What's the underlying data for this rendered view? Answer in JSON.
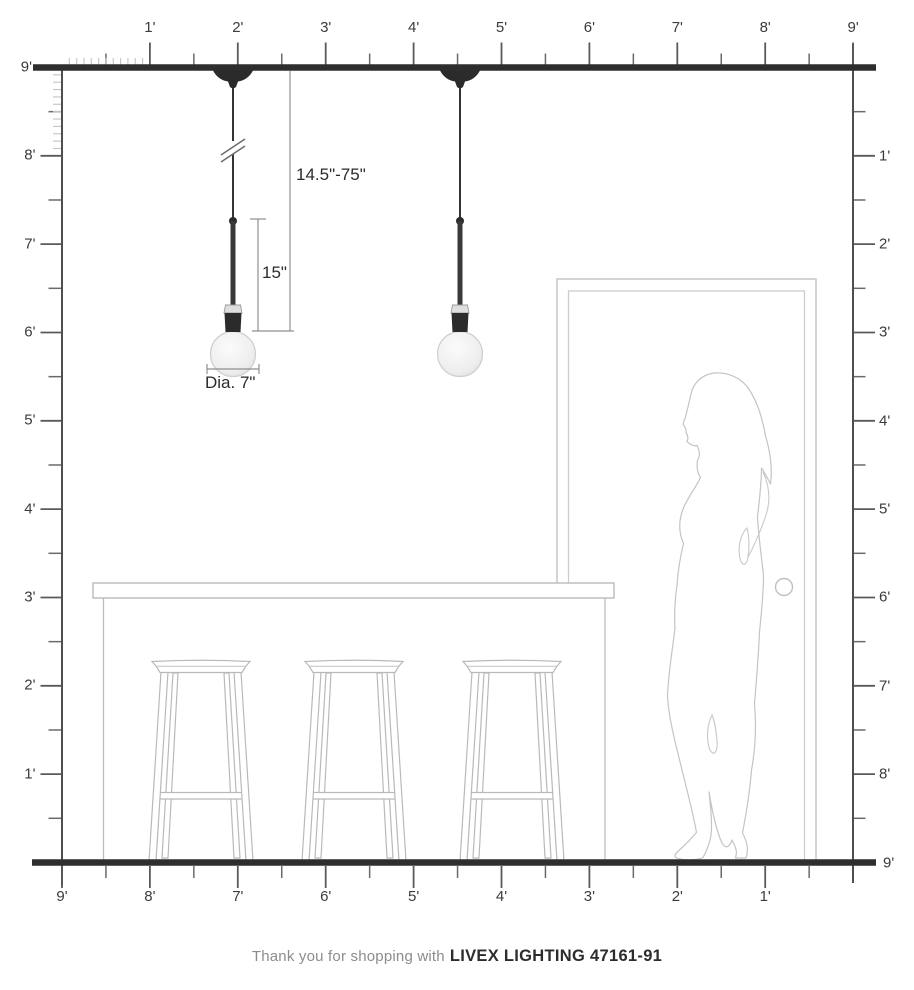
{
  "footer": {
    "prefix": "Thank you for shopping with",
    "brand": "LIVEX LIGHTING 47161-91"
  },
  "annotations": {
    "hang_range": "14.5\"-75\"",
    "fixture_height": "15\"",
    "fixture_diameter": "Dia. 7\""
  },
  "rulers": {
    "unit": "feet",
    "top": {
      "labels": [
        "1'",
        "2'",
        "3'",
        "4'",
        "5'",
        "6'",
        "7'",
        "8'",
        "9'"
      ]
    },
    "left": {
      "labels": [
        "9'",
        "8'",
        "7'",
        "6'",
        "5'",
        "4'",
        "3'",
        "2'",
        "1'"
      ]
    },
    "right": {
      "labels": [
        "1'",
        "2'",
        "3'",
        "4'",
        "5'",
        "6'",
        "7'",
        "8'",
        "9'"
      ]
    },
    "bottom": {
      "labels": [
        "9'",
        "8'",
        "7'",
        "6'",
        "5'",
        "4'",
        "3'",
        "2'",
        "1'"
      ]
    }
  },
  "scene": {
    "pendant_count": 2,
    "stool_count": 3
  },
  "colors": {
    "structure_line": "#2e2e2e",
    "ruler_line": "#555555",
    "fine_tick": "#c8c8c8",
    "furniture_outline": "#b9b9b9",
    "silhouette_outline": "#c4c4c4",
    "dimension_line": "#8f8f8f",
    "label_text": "#3b3b3b"
  }
}
